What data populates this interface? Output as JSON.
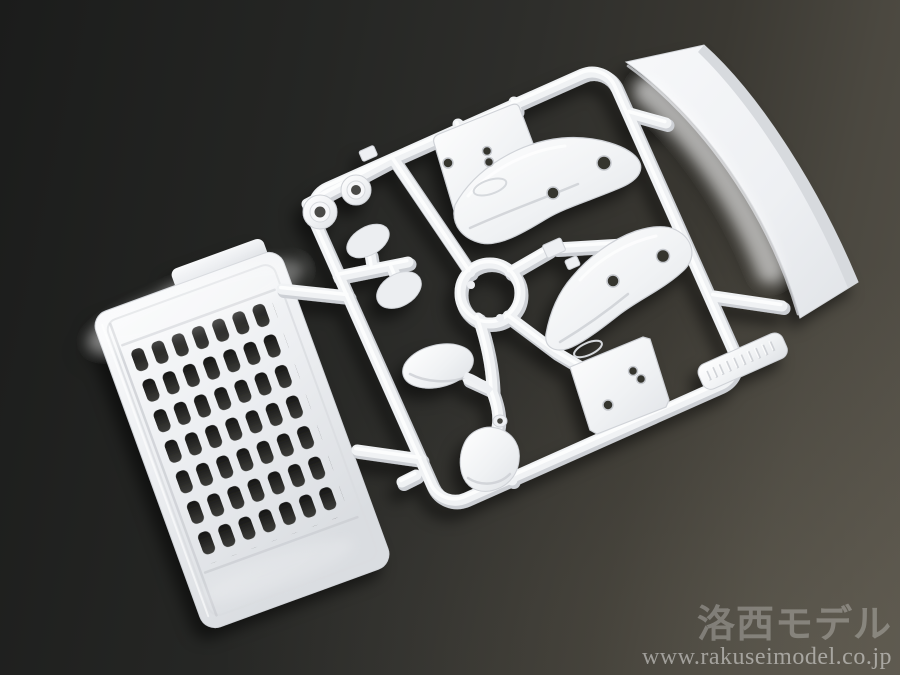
{
  "image_type": "product photo",
  "subject": "White injection-molded plastic model sprue (parts runner) with truck body parts photographed on a dark gray studio background",
  "scene": {
    "colors": {
      "background_top_left": "#1b1c1b",
      "background_bottom_right": "#555148",
      "plastic_white": "#f0f2f4",
      "plastic_shadow": "#cdd0d5",
      "grille_slot_dark": "#232322"
    },
    "parts": [
      {
        "name": "front-grille-panel",
        "description": "large louvered grille panel with 7x7 slot grid"
      },
      {
        "name": "spoiler-blade",
        "description": "long curved aero blade at top right"
      },
      {
        "name": "fender-upper",
        "description": "fender with mounting plate and drilled holes"
      },
      {
        "name": "fender-lower",
        "description": "fender with mounting plate and drilled holes"
      },
      {
        "name": "mirror-housing-upper",
        "description": "oval mirror housing on stalk"
      },
      {
        "name": "mirror-housing-lower",
        "description": "curved mirror housing shell"
      },
      {
        "name": "mirror-paddle-1",
        "description": "small teardrop mirror face"
      },
      {
        "name": "mirror-paddle-2",
        "description": "small teardrop mirror face"
      },
      {
        "name": "grommet-1",
        "description": "round stepped grommet"
      },
      {
        "name": "grommet-2",
        "description": "round stepped grommet"
      },
      {
        "name": "runner-frame",
        "description": "rounded rectangular sprue frame with center ring and branch runners"
      },
      {
        "name": "molded-tag",
        "description": "embossed identification tag on lower runner (text illegible)"
      }
    ]
  },
  "watermark": {
    "brand": "洛西モデル",
    "url": "www.rakuseimodel.co.jp"
  }
}
